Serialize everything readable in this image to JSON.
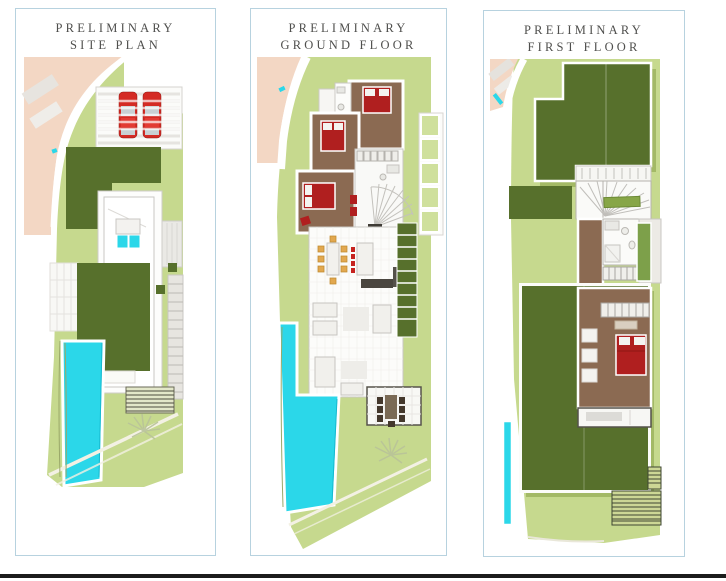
{
  "page": {
    "background": "#ffffff"
  },
  "panels": [
    {
      "id": "site-plan",
      "title_line1": "PRELIMINARY",
      "title_line2": "SITE PLAN"
    },
    {
      "id": "ground-floor",
      "title_line1": "PRELIMINARY",
      "title_line2": "GROUND FLOOR"
    },
    {
      "id": "first-floor",
      "title_line1": "PRELIMINARY",
      "title_line2": "FIRST FLOOR"
    }
  ],
  "colors": {
    "panel_border": "#b7d2df",
    "title_text": "#4f4f4d",
    "lawn_light": "#c6d98e",
    "lawn_pale": "#cfe09c",
    "hedge_dark": "#57702c",
    "roof_shadow": "#a3b966",
    "pool_cyan": "#2bd7e9",
    "road_salmon": "#f3d7c4",
    "car_red": "#d42b24",
    "bed_red": "#b01f1f",
    "floor_brown": "#8b6a52",
    "chair_tan": "#e2a84f",
    "stool_red": "#c6231f",
    "outdoor_furniture_dark": "#44382c",
    "counter_dark": "#4a463f",
    "planter_green": "#7da04a",
    "bottom_bar": "#1c1c1c"
  }
}
